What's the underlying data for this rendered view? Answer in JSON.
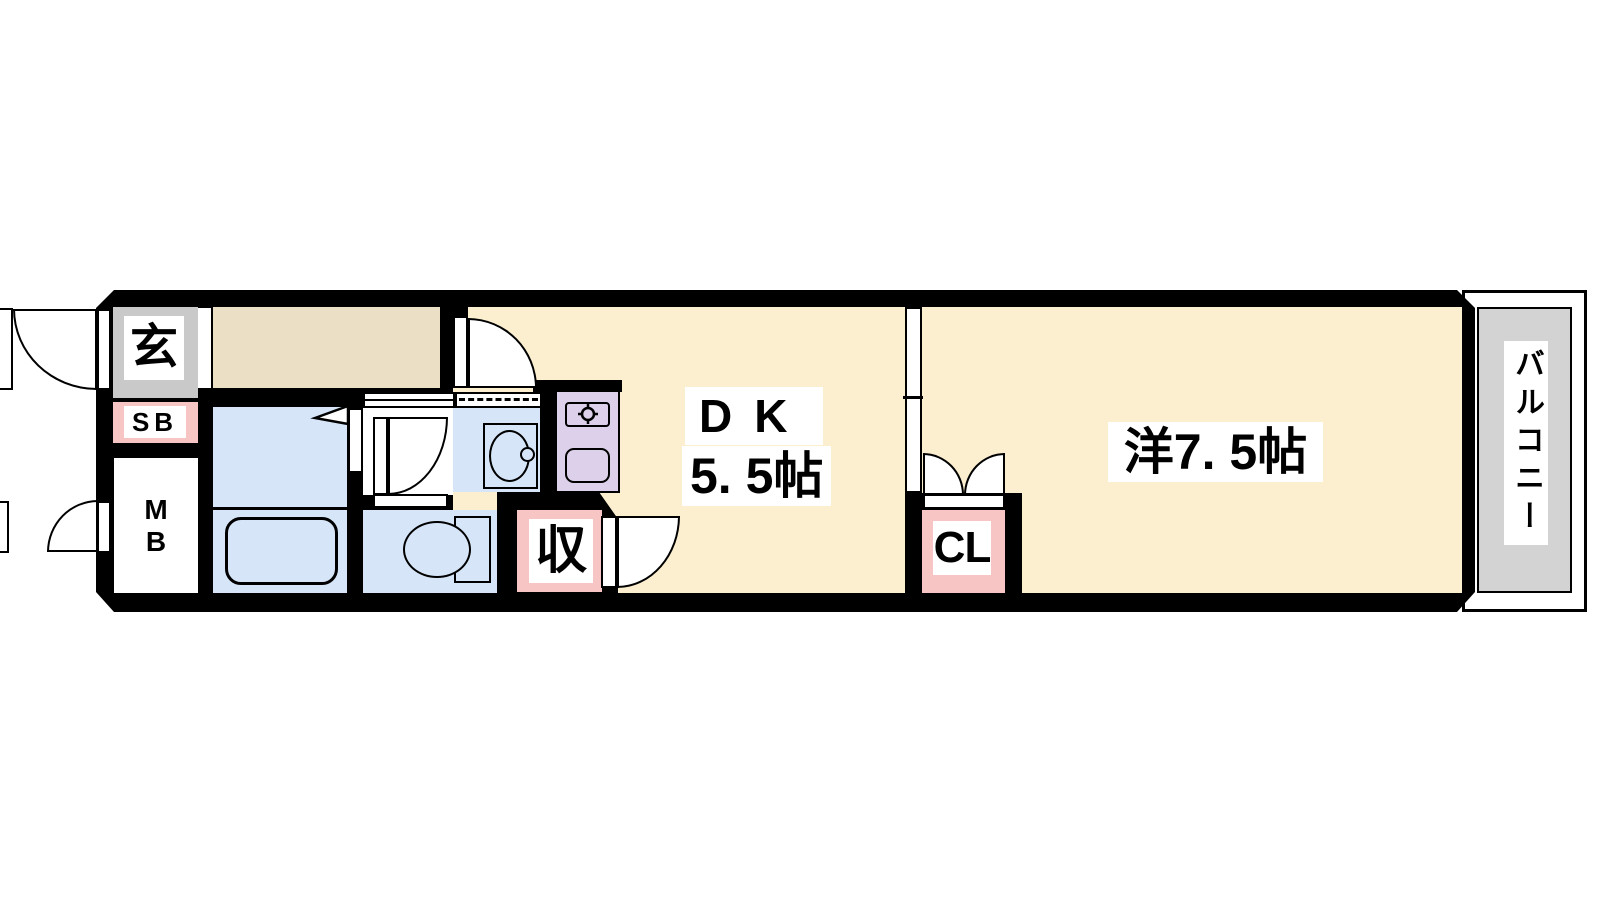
{
  "floorplan": {
    "title": "1DK apartment floor plan",
    "labels": {
      "entrance": "玄",
      "shoe_box": "SB",
      "meter_box": [
        "M",
        "B"
      ],
      "dk_name": "DK",
      "dk_size": "5. 5帖",
      "storage": "収",
      "closet": "CL",
      "western_room": "洋7. 5帖",
      "balcony": "バルコニー"
    },
    "colors": {
      "room_cream": "#FCEFCF",
      "hallway_beige": "#EBDFC5",
      "wet_area_blue": "#D6E6F8",
      "entrance_gray": "#C9C9C9",
      "balcony_gray": "#D3D3D3",
      "accent_pink": "#F8C5C5",
      "kitchen_lavender": "#DCD0EA",
      "wall_black": "#000000"
    }
  }
}
